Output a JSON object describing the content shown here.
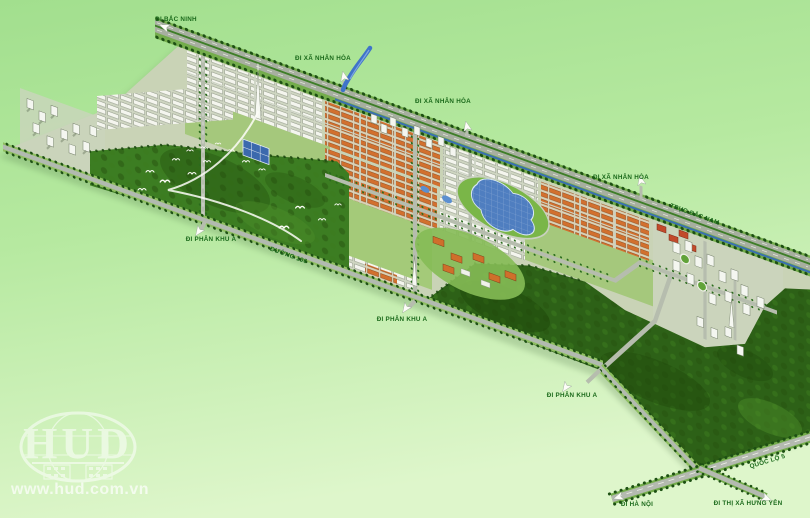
{
  "map": {
    "type": "master-plan aerial rendering",
    "road_labels": {
      "di_bac_ninh": "ĐI BẮC NINH",
      "di_xa_nhan_hoa": "ĐI XÃ NHÂN HÒA",
      "truc_bac_nam": "TRỤC BẮC NAM",
      "di_phan_khu_a": "ĐI PHÂN KHU A",
      "duong_196": "ĐƯỜNG 196",
      "quoc_lo_5": "QUỐC LỘ 5",
      "di_ha_noi": "ĐI HÀ NỘI",
      "di_thi_xa_hung_yen": "ĐI THỊ XÃ HƯNG YÊN"
    },
    "colors": {
      "label_green": "#1b6a1b",
      "background_top": "#a2df8e",
      "background_bottom": "#def6cb",
      "park_green": "#3c7d22",
      "forest_green": "#2d6117",
      "water_blue": "#4f7ec0",
      "road_gray": "#b2bab0",
      "tree_green": "#1d5013",
      "roof_orange": "#d2702e",
      "roof_red": "#c24a2b"
    }
  },
  "watermark": {
    "logo_text": "HUD",
    "website": "www.hud.com.vn"
  }
}
